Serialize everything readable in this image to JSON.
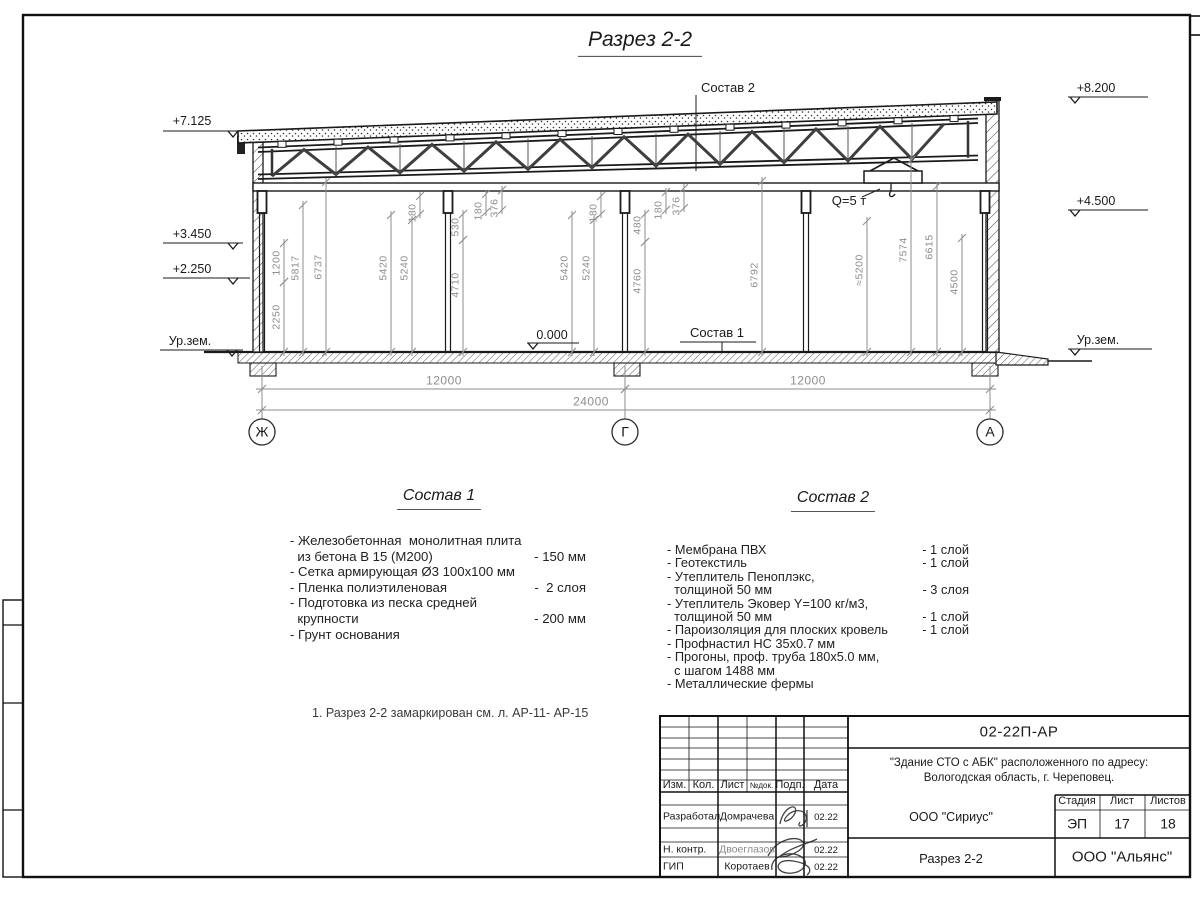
{
  "colors": {
    "ink": "#1a1a1a",
    "dim": "#8e8e8e",
    "hatch": "#555555"
  },
  "header": {
    "title": "Разрез 2-2"
  },
  "drawing": {
    "callouts": {
      "sostav1": "Состав 1",
      "sostav2": "Состав 2",
      "crane": "Q=5 т"
    },
    "elevation_marks": [
      {
        "label": "+7.125",
        "tx": 192,
        "ty": 122,
        "shelf": [
          163,
          243,
          131
        ],
        "vx": 233
      },
      {
        "label": "+3.450",
        "tx": 192,
        "ty": 235,
        "shelf": [
          163,
          243,
          243
        ],
        "vx": 233
      },
      {
        "label": "+2.250",
        "tx": 192,
        "ty": 270,
        "shelf": [
          163,
          250,
          278
        ],
        "vx": 233
      },
      {
        "label": "Ур.зем.",
        "tx": 190,
        "ty": 342,
        "shelf": [
          160,
          243,
          350
        ],
        "vx": 232
      },
      {
        "label": "+8.200",
        "tx": 1096,
        "ty": 89,
        "shelf": [
          1068,
          1148,
          97
        ],
        "vx": 1075
      },
      {
        "label": "+4.500",
        "tx": 1096,
        "ty": 202,
        "shelf": [
          1068,
          1148,
          210
        ],
        "vx": 1075
      },
      {
        "label": "Ур.зем.",
        "tx": 1098,
        "ty": 341,
        "shelf": [
          1068,
          1152,
          349
        ],
        "vx": 1075
      },
      {
        "label": "0.000",
        "tx": 552,
        "ty": 336,
        "shelf": [
          527,
          579,
          343
        ],
        "vx": 533
      }
    ],
    "vertical_dims": [
      {
        "label": "1200",
        "x": 284,
        "y1": 243,
        "y2": 282,
        "ly": 263
      },
      {
        "label": "2250",
        "x": 284,
        "y1": 282,
        "y2": 352,
        "ly": 317
      },
      {
        "label": "5817",
        "x": 303,
        "y1": 205,
        "y2": 352,
        "ly": 268
      },
      {
        "label": "6737",
        "x": 326,
        "y1": 182,
        "y2": 352,
        "ly": 267
      },
      {
        "label": "5420",
        "x": 391,
        "y1": 215,
        "y2": 352,
        "ly": 268
      },
      {
        "label": "5240",
        "x": 412,
        "y1": 220,
        "y2": 352,
        "ly": 268
      },
      {
        "label": "180",
        "x": 420,
        "y1": 196,
        "y2": 214,
        "ly": 213
      },
      {
        "label": "530",
        "x": 463,
        "y1": 214,
        "y2": 240,
        "ly": 227
      },
      {
        "label": "4710",
        "x": 463,
        "y1": 240,
        "y2": 352,
        "ly": 285
      },
      {
        "label": "180",
        "x": 486,
        "y1": 194,
        "y2": 212,
        "ly": 211
      },
      {
        "label": "376",
        "x": 502,
        "y1": 190,
        "y2": 210,
        "ly": 208
      },
      {
        "label": "5420",
        "x": 572,
        "y1": 215,
        "y2": 352,
        "ly": 268
      },
      {
        "label": "5240",
        "x": 594,
        "y1": 220,
        "y2": 352,
        "ly": 268
      },
      {
        "label": "180",
        "x": 601,
        "y1": 196,
        "y2": 214,
        "ly": 213
      },
      {
        "label": "480",
        "x": 645,
        "y1": 214,
        "y2": 242,
        "ly": 225
      },
      {
        "label": "4760",
        "x": 645,
        "y1": 242,
        "y2": 352,
        "ly": 281
      },
      {
        "label": "180",
        "x": 666,
        "y1": 192,
        "y2": 210,
        "ly": 210
      },
      {
        "label": "376",
        "x": 684,
        "y1": 188,
        "y2": 208,
        "ly": 206
      },
      {
        "label": "6792",
        "x": 762,
        "y1": 181,
        "y2": 352,
        "ly": 275
      },
      {
        "label": "≈5200",
        "x": 867,
        "y1": 221,
        "y2": 352,
        "ly": 270
      },
      {
        "label": "7574",
        "x": 911,
        "y1": 160,
        "y2": 352,
        "ly": 250
      },
      {
        "label": "6615",
        "x": 937,
        "y1": 186,
        "y2": 352,
        "ly": 247
      },
      {
        "label": "4500",
        "x": 962,
        "y1": 238,
        "y2": 352,
        "ly": 282
      }
    ],
    "horizontal_dims": [
      {
        "label": "12000",
        "x1": 262,
        "x2": 625,
        "y": 389,
        "lx": 444,
        "ly": 381
      },
      {
        "label": "12000",
        "x1": 625,
        "x2": 990,
        "y": 389,
        "lx": 808,
        "ly": 381
      },
      {
        "label": "24000",
        "x1": 262,
        "x2": 990,
        "y": 410,
        "lx": 591,
        "ly": 402
      }
    ],
    "axes": [
      {
        "label": "Ж",
        "x": 262
      },
      {
        "label": "Г",
        "x": 625
      },
      {
        "label": "А",
        "x": 990
      }
    ]
  },
  "composition1": {
    "heading": "Состав 1",
    "rows": [
      {
        "t": "- Железобетонная  монолитная плита",
        "v": ""
      },
      {
        "t": "  из бетона В 15 (М200)",
        "v": "- 150 мм"
      },
      {
        "t": "- Сетка армирующая Ø3 100х100 мм",
        "v": ""
      },
      {
        "t": "- Пленка полиэтиленовая",
        "v": "-  2 слоя"
      },
      {
        "t": "- Подготовка из песка средней",
        "v": ""
      },
      {
        "t": "  крупности",
        "v": "- 200 мм"
      },
      {
        "t": "- Грунт основания",
        "v": ""
      }
    ]
  },
  "composition2": {
    "heading": "Состав 2",
    "rows": [
      {
        "t": "- Мембрана ПВХ",
        "v": "- 1 слой"
      },
      {
        "t": "- Геотекстиль",
        "v": "- 1 слой"
      },
      {
        "t": "- Утеплитель Пеноплэкс,",
        "v": ""
      },
      {
        "t": "  толщиной 50 мм",
        "v": "- 3 слоя"
      },
      {
        "t": "- Утеплитель Эковер Y=100 кг/м3,",
        "v": ""
      },
      {
        "t": "  толщиной 50 мм",
        "v": "- 1 слой"
      },
      {
        "t": "- Пароизоляция для плоских кровель",
        "v": "- 1 слой"
      },
      {
        "t": "- Профнастил НС 35х0.7 мм",
        "v": ""
      },
      {
        "t": "- Прогоны, проф. труба 180х5.0 мм,",
        "v": ""
      },
      {
        "t": "  с шагом 1488 мм",
        "v": ""
      },
      {
        "t": "- Металлические фермы",
        "v": ""
      }
    ]
  },
  "note": "1. Разрез 2-2 замаркирован см. л. АР-11- АР-15",
  "title_block": {
    "doc_number": "02-22П-АР",
    "project_line1": "\"Здание СТО с АБК\" расположенного по адресу:",
    "project_line2": "Вологодская область, г. Череповец.",
    "header_cells": [
      "Изм.",
      "Кол.",
      "Лист",
      "№док.",
      "Подп.",
      "Дата"
    ],
    "stage_label": "Стадия",
    "sheet_label": "Лист",
    "sheets_label": "Листов",
    "stage": "ЭП",
    "sheet": "17",
    "sheets": "18",
    "org": "ООО \"Сириус\"",
    "drawing_name": "Разрез 2-2",
    "company": "ООО \"Альянс\"",
    "roles": [
      {
        "role": "Разработал",
        "name": "Домрачева",
        "date": "02.22"
      },
      {
        "role": "Н. контр.",
        "name": "Двоеглазов",
        "date": "02.22"
      },
      {
        "role": "ГИП",
        "name": "Коротаев",
        "date": "02.22"
      }
    ]
  }
}
